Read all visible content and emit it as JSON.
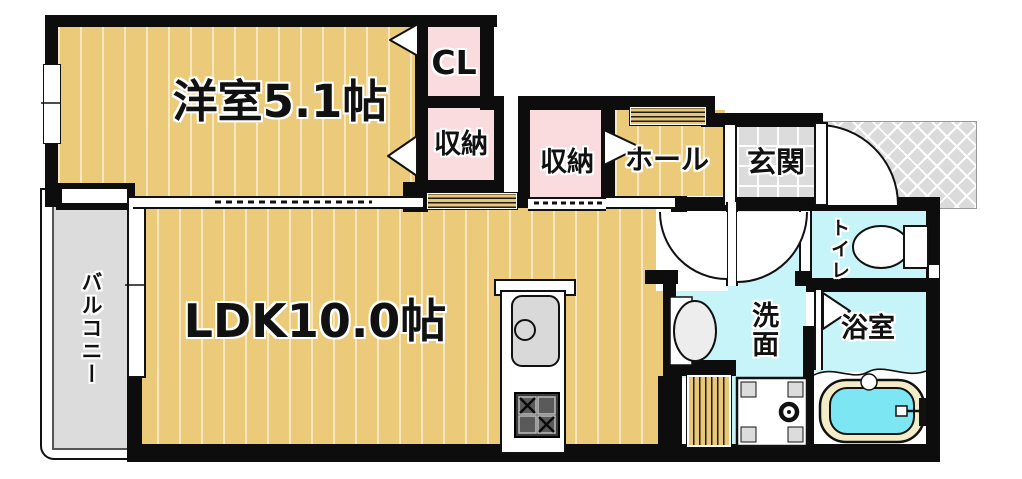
{
  "floorplan": {
    "type": "apartment-floor-plan",
    "rooms": {
      "bedroom": {
        "label": "洋室5.1帖"
      },
      "closet": {
        "label": "CL"
      },
      "storage_a": {
        "label": "収納"
      },
      "storage_b": {
        "label": "収納"
      },
      "hall": {
        "label": "ホール"
      },
      "entrance": {
        "label": "玄関"
      },
      "toilet": {
        "label": "トイレ"
      },
      "washroom": {
        "label": "洗面"
      },
      "bathroom": {
        "label": "浴室"
      },
      "ldk": {
        "label": "LDK10.0帖"
      },
      "balcony": {
        "label": "バルコニー"
      }
    },
    "fixtures": [
      "kitchen-sink",
      "gas-stove",
      "washbasin",
      "washing-machine-pan",
      "toilet-bowl",
      "bathtub"
    ],
    "colors": {
      "flooring_tan": "#EBCA79",
      "closet_pink": "#FADBDE",
      "wet_area_cyan": "#C7F4F8",
      "bath_water": "#7CE7F2",
      "tub_rim": "#F2ECC8",
      "tile_gray": "#DCDCDC",
      "wall_black": "#0D0D0D"
    }
  }
}
